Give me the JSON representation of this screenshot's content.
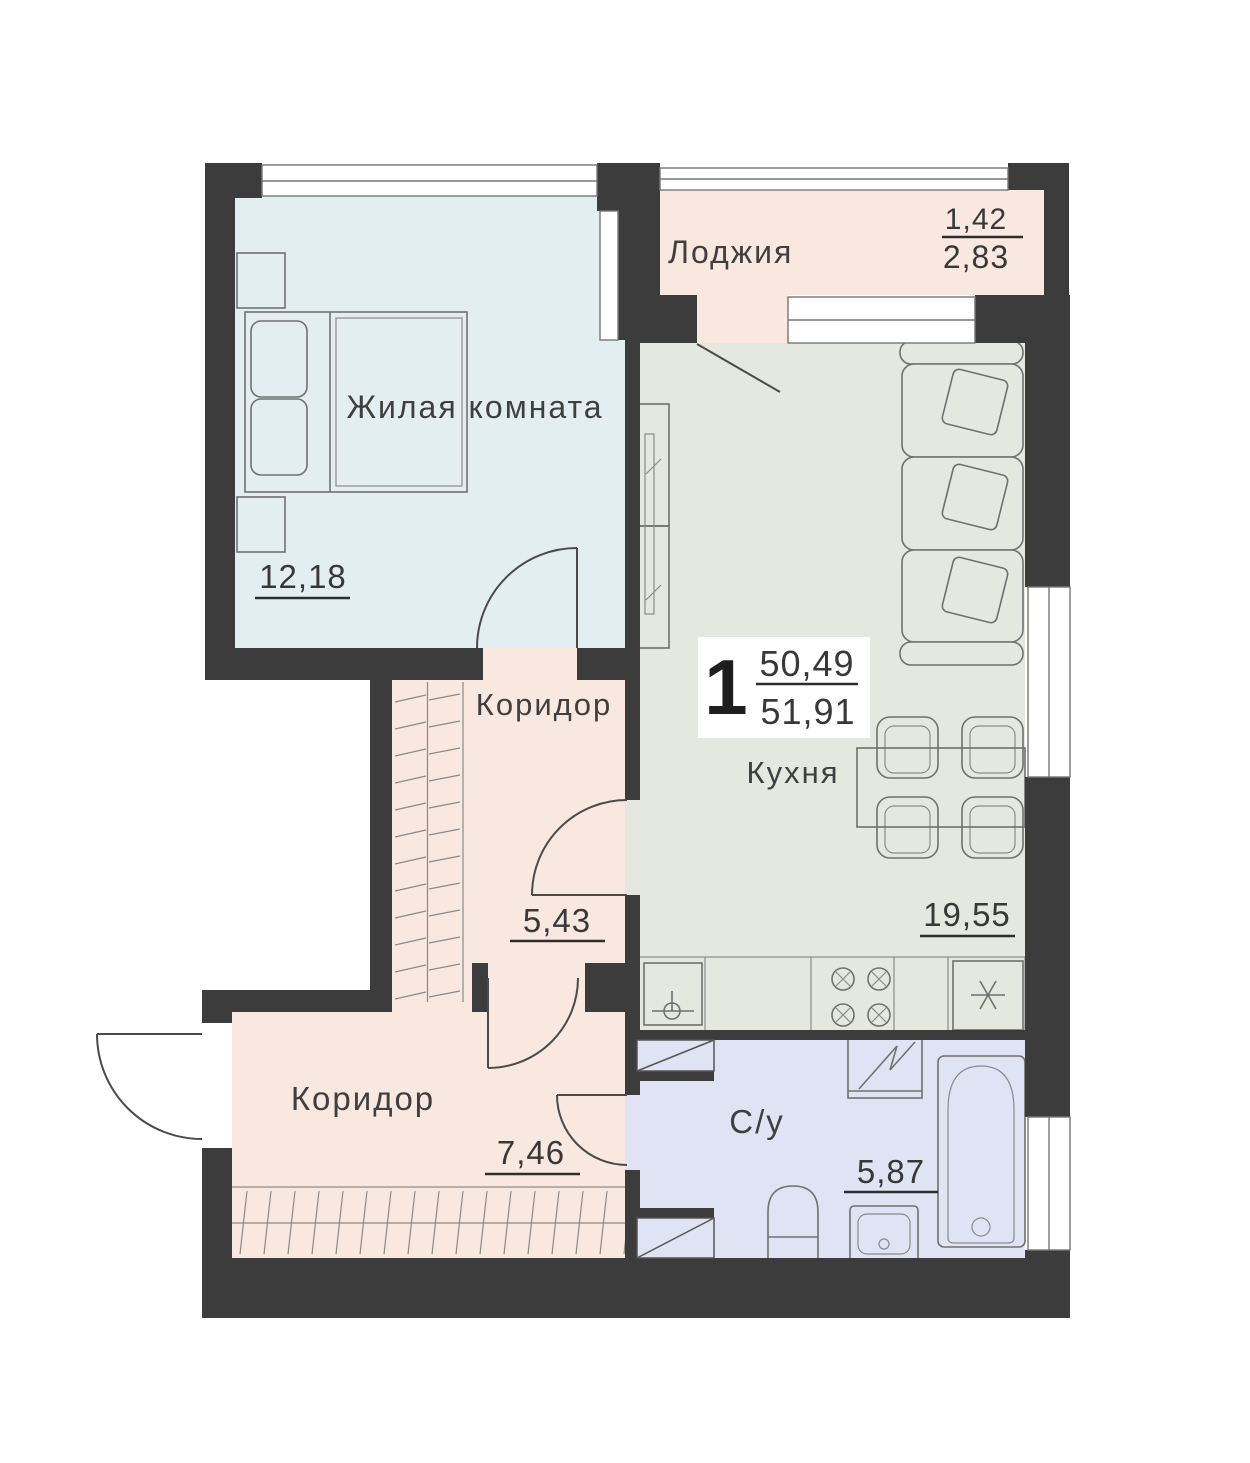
{
  "floor_plan": {
    "badge": {
      "room_count": "1",
      "living_area": "50,49",
      "total_area": "51,91"
    },
    "living": {
      "label": "Жилая комната",
      "area": "12,18"
    },
    "loggia": {
      "label": "Лоджия",
      "area_reduced": "1,42",
      "area_full": "2,83"
    },
    "corridor_upper": {
      "label": "Коридор",
      "area": "5,43"
    },
    "kitchen": {
      "label": "Кухня",
      "area": "19,55"
    },
    "corridor_lower": {
      "label": "Коридор",
      "area": "7,46"
    },
    "bathroom": {
      "label": "С/у",
      "area": "5,87"
    },
    "colors": {
      "wall": "#3c3c3c",
      "living_fill": "#e3eef0",
      "kitchen_fill": "#e4e8df",
      "corridor_fill": "#f8e8e0",
      "loggia_fill": "#f8e8e0",
      "bathroom_fill": "#e0e3f4"
    }
  }
}
